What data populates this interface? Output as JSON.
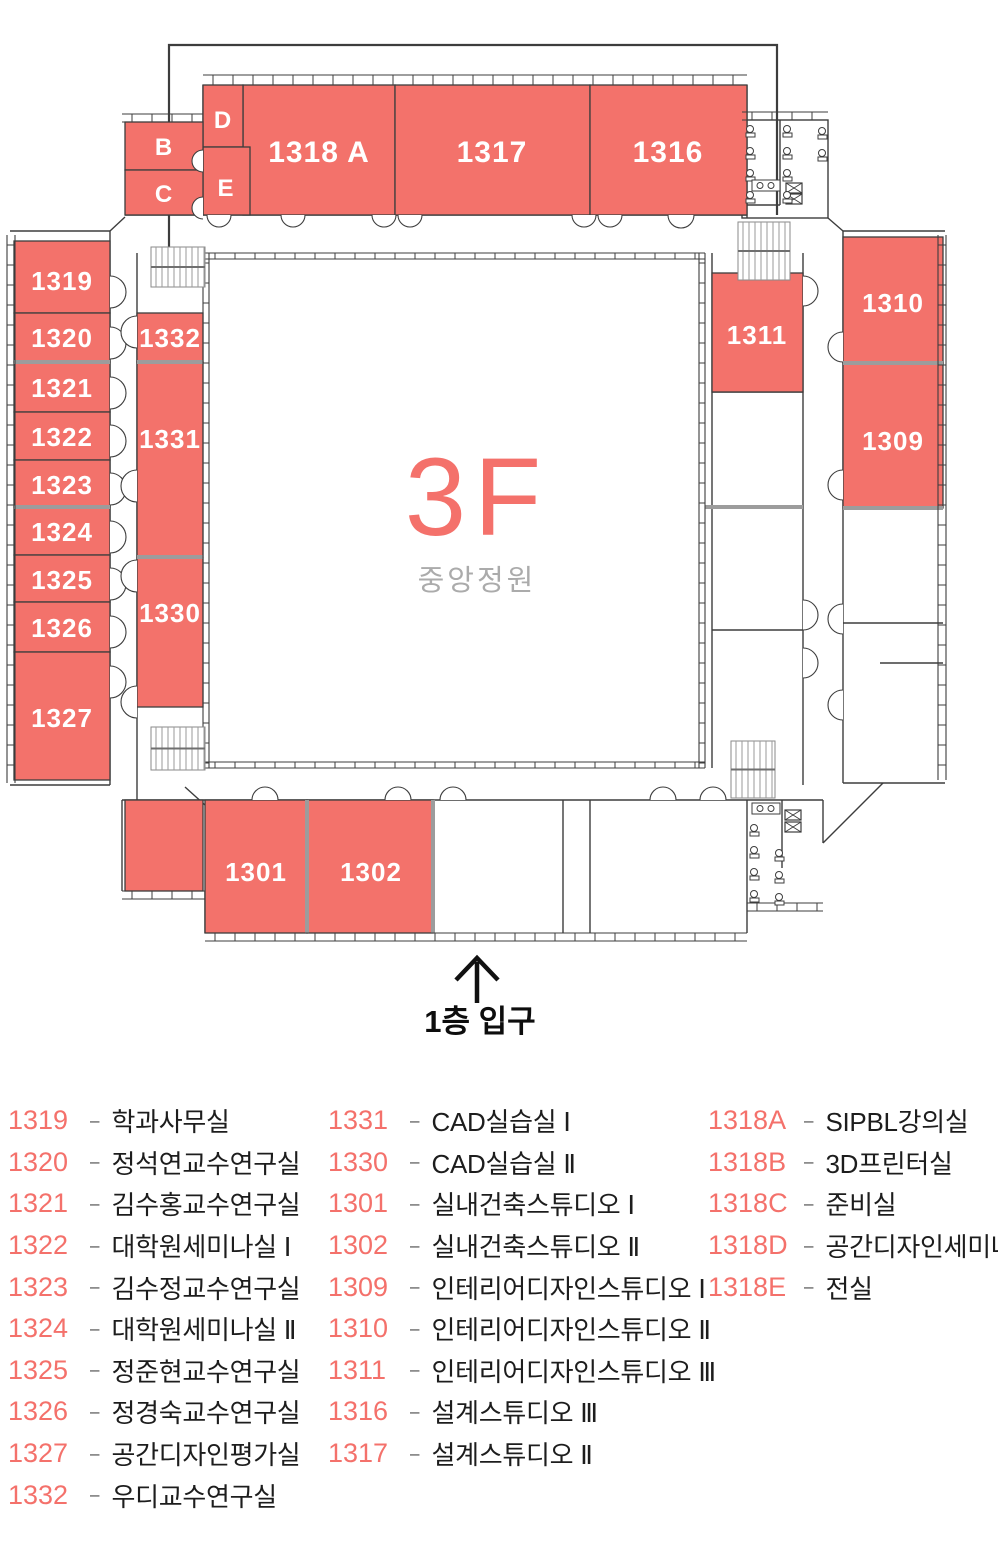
{
  "plan": {
    "floor_label": "3F",
    "courtyard_label": "중앙정원",
    "entrance_label": "1층 입구",
    "rooms": {
      "rB": "B",
      "rC": "C",
      "rD": "D",
      "rE": "E",
      "r1318a": "1318 A",
      "r1317": "1317",
      "r1316": "1316",
      "r1319": "1319",
      "r1320": "1320",
      "r1321": "1321",
      "r1322": "1322",
      "r1323": "1323",
      "r1324": "1324",
      "r1325": "1325",
      "r1326": "1326",
      "r1327": "1327",
      "r1332": "1332",
      "r1331": "1331",
      "r1330": "1330",
      "r1311": "1311",
      "r1310": "1310",
      "r1309": "1309",
      "r1301": "1301",
      "r1302": "1302"
    }
  },
  "legend": {
    "separator": "–",
    "col1": [
      {
        "number": "1319",
        "name": "학과사무실"
      },
      {
        "number": "1320",
        "name": "정석연교수연구실"
      },
      {
        "number": "1321",
        "name": "김수홍교수연구실"
      },
      {
        "number": "1322",
        "name": "대학원세미나실 Ⅰ"
      },
      {
        "number": "1323",
        "name": "김수정교수연구실"
      },
      {
        "number": "1324",
        "name": "대학원세미나실 Ⅱ"
      },
      {
        "number": "1325",
        "name": "정준현교수연구실"
      },
      {
        "number": "1326",
        "name": "정경숙교수연구실"
      },
      {
        "number": "1327",
        "name": "공간디자인평가실"
      },
      {
        "number": "1332",
        "name": "우디교수연구실"
      }
    ],
    "col2": [
      {
        "number": "1331",
        "name": "CAD실습실 Ⅰ"
      },
      {
        "number": "1330",
        "name": "CAD실습실 Ⅱ"
      },
      {
        "number": "1301",
        "name": "실내건축스튜디오 Ⅰ"
      },
      {
        "number": "1302",
        "name": "실내건축스튜디오 Ⅱ"
      },
      {
        "number": "1309",
        "name": "인테리어디자인스튜디오 Ⅰ"
      },
      {
        "number": "1310",
        "name": "인테리어디자인스튜디오 Ⅱ"
      },
      {
        "number": "1311",
        "name": "인테리어디자인스튜디오 Ⅲ"
      },
      {
        "number": "1316",
        "name": "설계스튜디오 Ⅲ"
      },
      {
        "number": "1317",
        "name": "설계스튜디오 Ⅱ"
      }
    ],
    "col3": [
      {
        "number": "1318A",
        "name": "SIPBL강의실"
      },
      {
        "number": "1318B",
        "name": "3D프린터실"
      },
      {
        "number": "1318C",
        "name": "준비실"
      },
      {
        "number": "1318D",
        "name": "공간디자인세미나실"
      },
      {
        "number": "1318E",
        "name": "전실"
      }
    ]
  },
  "colors": {
    "room_fill": "#f3726b",
    "accent": "#f4716b",
    "muted": "#ababab",
    "ink": "#1d1d1d"
  }
}
